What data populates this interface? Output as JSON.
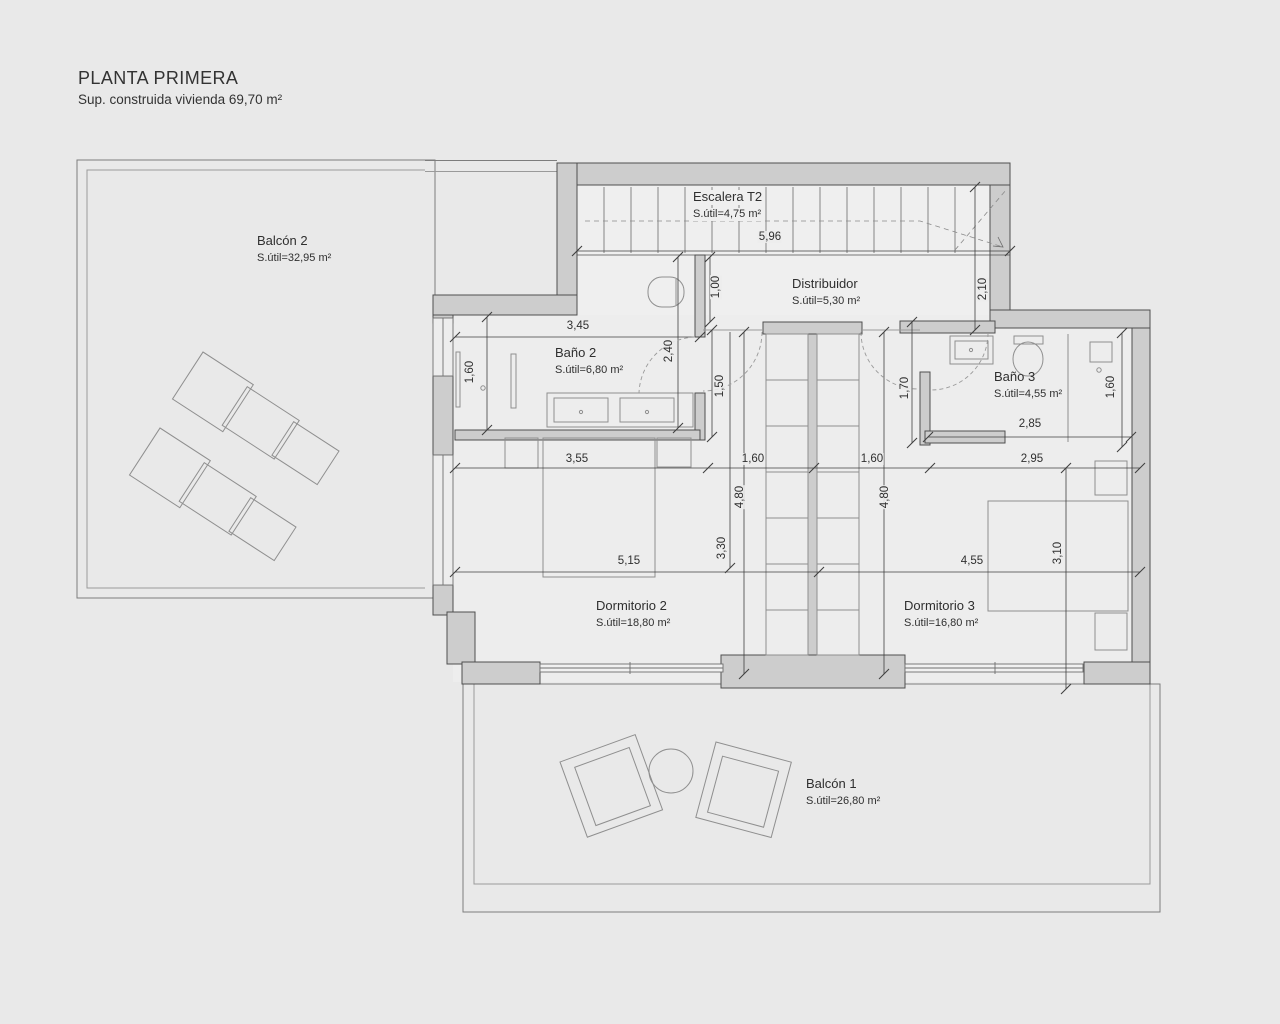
{
  "header": {
    "title": "PLANTA PRIMERA",
    "subtitle": "Sup. construida vivienda 69,70 m²"
  },
  "rooms": [
    {
      "name": "Balcón 2",
      "area": "S.útil=32,95 m²"
    },
    {
      "name": "Escalera T2",
      "area": "S.útil=4,75 m²"
    },
    {
      "name": "Distribuidor",
      "area": "S.útil=5,30 m²"
    },
    {
      "name": "Baño 2",
      "area": "S.útil=6,80 m²"
    },
    {
      "name": "Baño 3",
      "area": "S.útil=4,55 m²"
    },
    {
      "name": "Dormitorio 2",
      "area": "S.útil=18,80 m²"
    },
    {
      "name": "Dormitorio 3",
      "area": "S.útil=16,80 m²"
    },
    {
      "name": "Balcón 1",
      "area": "S.útil=26,80 m²"
    }
  ],
  "dims": [
    "5,96",
    "2,10",
    "1,00",
    "3,45",
    "1,60",
    "2,40",
    "1,50",
    "1,70",
    "2,85",
    "1,60",
    "3,55",
    "1,60",
    "1,60",
    "2,95",
    "4,80",
    "4,80",
    "3,30",
    "3,10",
    "5,15",
    "4,55"
  ],
  "colors": {
    "background": "#e9e9e9",
    "floor": "#ededed",
    "wall_fill": "#cdcdcd",
    "wall_outline": "#4f4f4f",
    "dimension_line": "#3f3f3f",
    "furniture_line": "#909090",
    "text": "#303030"
  }
}
